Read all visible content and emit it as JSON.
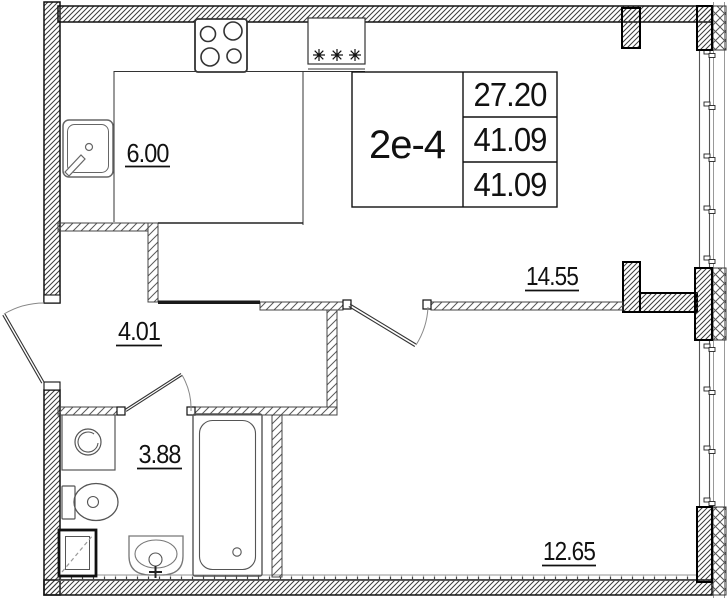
{
  "unit": {
    "label": "2е-4",
    "area_table": {
      "row1": "27.20",
      "row2": "41.09",
      "row3": "41.09"
    }
  },
  "rooms": {
    "kitchen": "6.00",
    "hallway": "4.01",
    "bathroom": "3.88",
    "living": "14.55",
    "bedroom": "12.65"
  },
  "icons": {
    "ventilation": "vent-stars-icon",
    "stove": "stove-4-burners",
    "sink_kitchen": "kitchen-sink",
    "washer": "washing-machine",
    "toilet": "toilet",
    "shaft": "utility-shaft",
    "sink_bath": "bathroom-sink",
    "bathtub": "bathtub"
  },
  "colors": {
    "wall_line": "#111111",
    "partition_line": "#444444",
    "fixture_line": "#666666",
    "glazing_line": "#999999",
    "background": "#ffffff"
  }
}
